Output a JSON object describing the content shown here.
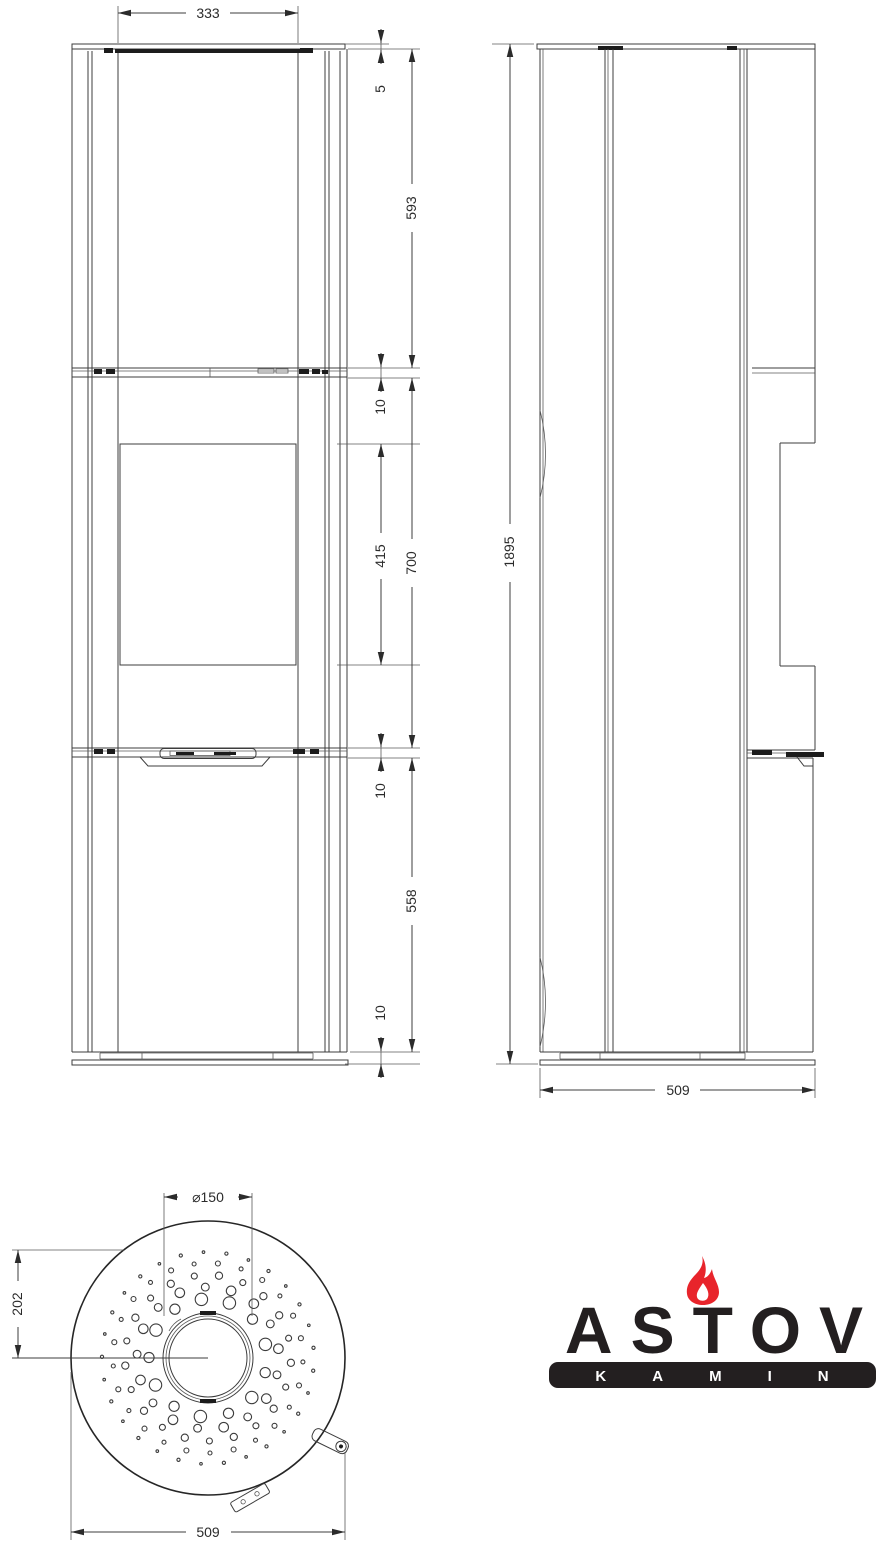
{
  "dims": {
    "front_glass_width": "333",
    "top_plate": "5",
    "upper_section": "593",
    "gap_upper": "10",
    "door_window": "415",
    "middle_section": "700",
    "gap_lower": "10",
    "lower_section": "558",
    "base_height": "10",
    "total_height": "1895",
    "depth": "509",
    "flue_diameter": "⌀150",
    "flue_offset": "202",
    "body_diameter": "509"
  },
  "logo": {
    "brand": "ASTOV",
    "tagline": "KAMIN"
  },
  "colors": {
    "line": "#3c3c3c",
    "dark": "#1c1c1c",
    "flame_red": "#e8242b",
    "logo_black": "#231f20"
  }
}
